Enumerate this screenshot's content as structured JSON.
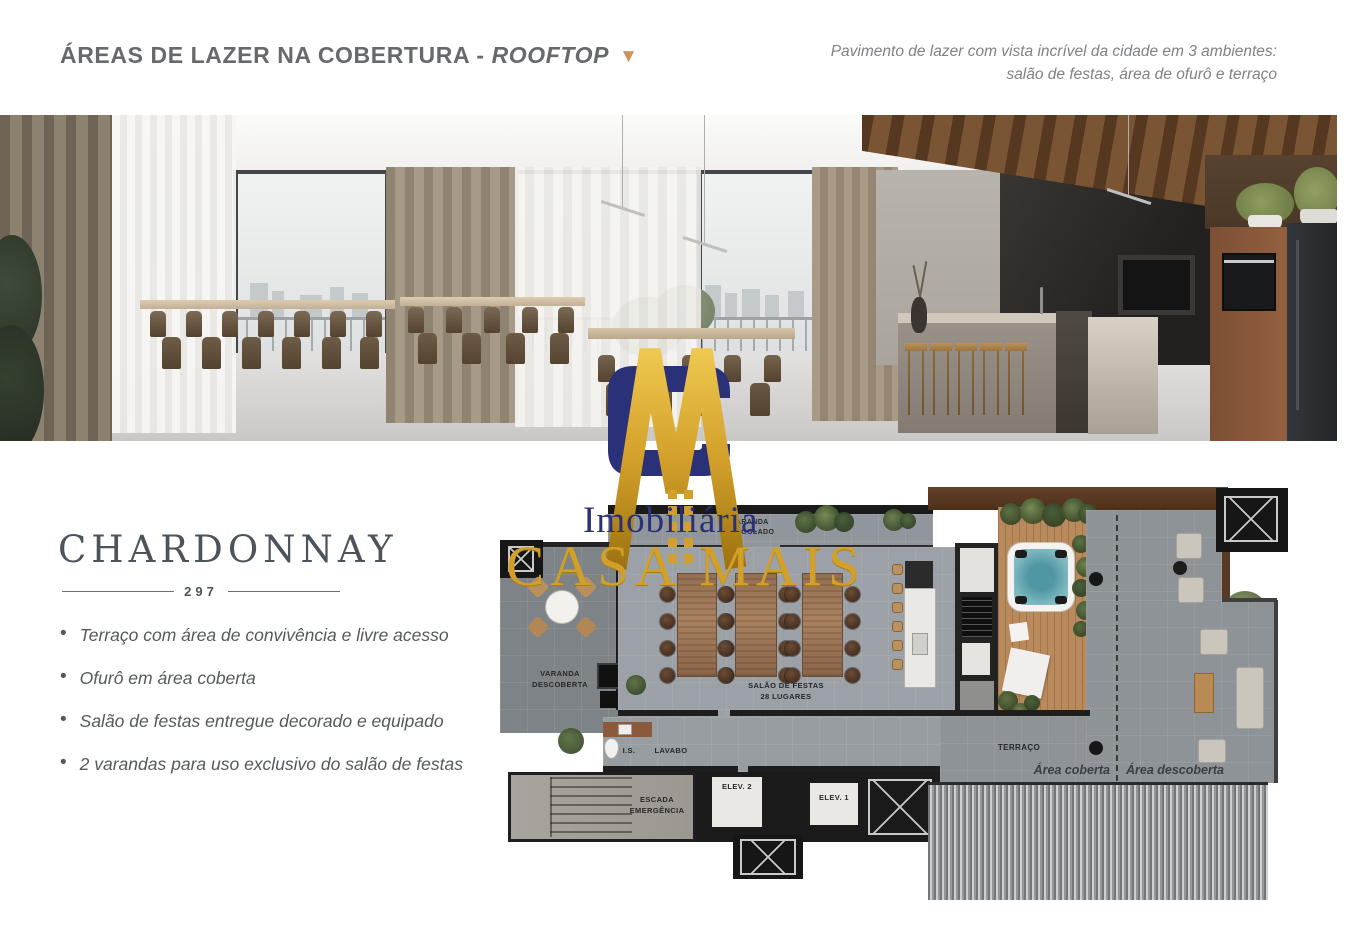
{
  "header": {
    "title_main": "ÁREAS DE LAZER NA COBERTURA - ",
    "title_italic": "ROOFTOP",
    "arrow": "▼",
    "accent_color": "#c8955e",
    "tagline_line1": "Pavimento de lazer com vista incrível da cidade em 3 ambientes:",
    "tagline_line2": "salão de festas, área de ofurô e terraço"
  },
  "brand": {
    "name": "CHARDONNAY",
    "number": "297"
  },
  "features": {
    "items": [
      {
        "text": "Terraço com área de convivência e livre acesso"
      },
      {
        "text": "Ofurô em área coberta"
      },
      {
        "text": "Salão de festas entregue decorado e equipado"
      },
      {
        "text": "2 varandas para uso exclusivo do salão de festas"
      }
    ]
  },
  "watermark": {
    "word1": "Imobiliária",
    "word2": "CASA MAIS",
    "navy": "#2b3178",
    "gold": "#d2a02a"
  },
  "floorplan": {
    "labels": {
      "varanda_pergolado_1": "VARANDA",
      "varanda_pergolado_2": "PERGOLADO",
      "varanda_descoberta_1": "VARANDA",
      "varanda_descoberta_2": "DESCOBERTA",
      "salao_1": "SALÃO DE FESTAS",
      "salao_2": "28 LUGARES",
      "is": "I.S.",
      "lavabo": "LAVABO",
      "escada_1": "ESCADA",
      "escada_2": "EMERGÊNCIA",
      "elev2": "ELEV. 2",
      "elev1": "ELEV. 1",
      "terraco": "TERRAÇO",
      "area_coberta": "Área coberta",
      "area_descoberta": "Área descoberta"
    }
  }
}
